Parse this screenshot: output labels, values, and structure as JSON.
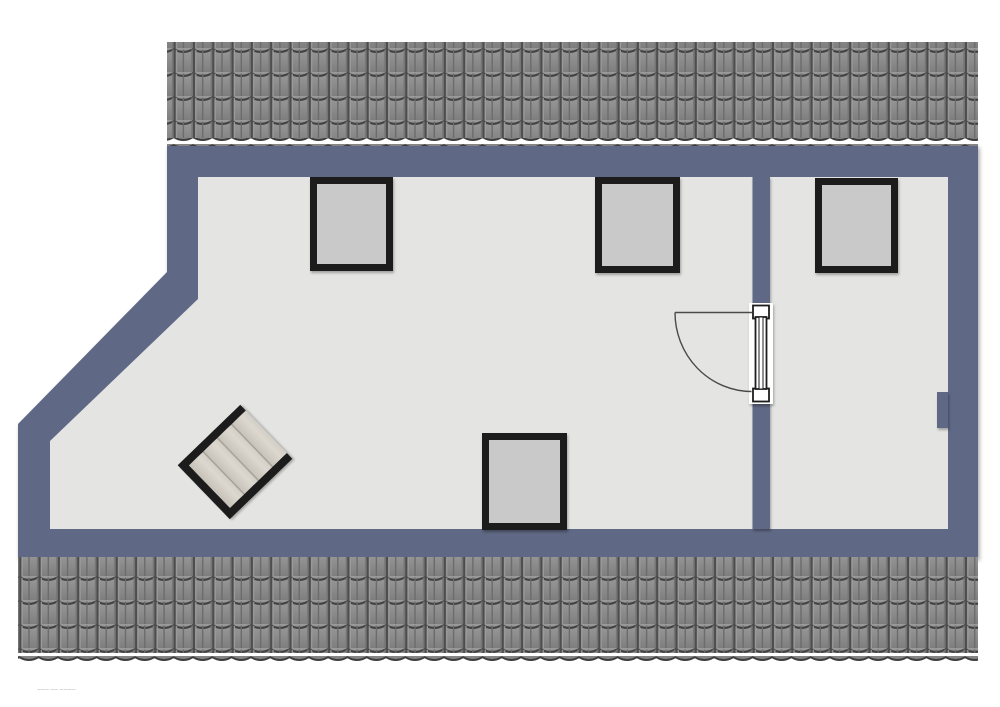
{
  "plan": {
    "fine_print": "——— —— ————",
    "colors": {
      "background": "#ffffff",
      "wall": "#5e6884",
      "floor": "#e4e4e2",
      "roof_tile": "#8d8d8d",
      "roof_tile_dark": "#424242",
      "skylight_fill": "#c9c9c9",
      "frame_black": "#1d1d1d",
      "stair_tread": "#d6d2c9",
      "door_line": "#4a4a4a"
    },
    "elements": {
      "rooms": [
        {
          "id": "main-room"
        },
        {
          "id": "right-room"
        }
      ],
      "skylights": [
        {
          "id": "skylight-top-left",
          "wall": "top"
        },
        {
          "id": "skylight-top-middle",
          "wall": "top"
        },
        {
          "id": "skylight-right-room",
          "wall": "top"
        },
        {
          "id": "skylight-bottom",
          "wall": "bottom"
        }
      ],
      "door": {
        "id": "interior-door",
        "type": "single-swing",
        "swing": "quarter-arc"
      },
      "staircase": {
        "id": "staircase",
        "treads": 4
      },
      "roof_bands": [
        {
          "id": "roof-top"
        },
        {
          "id": "roof-bottom"
        }
      ]
    }
  }
}
